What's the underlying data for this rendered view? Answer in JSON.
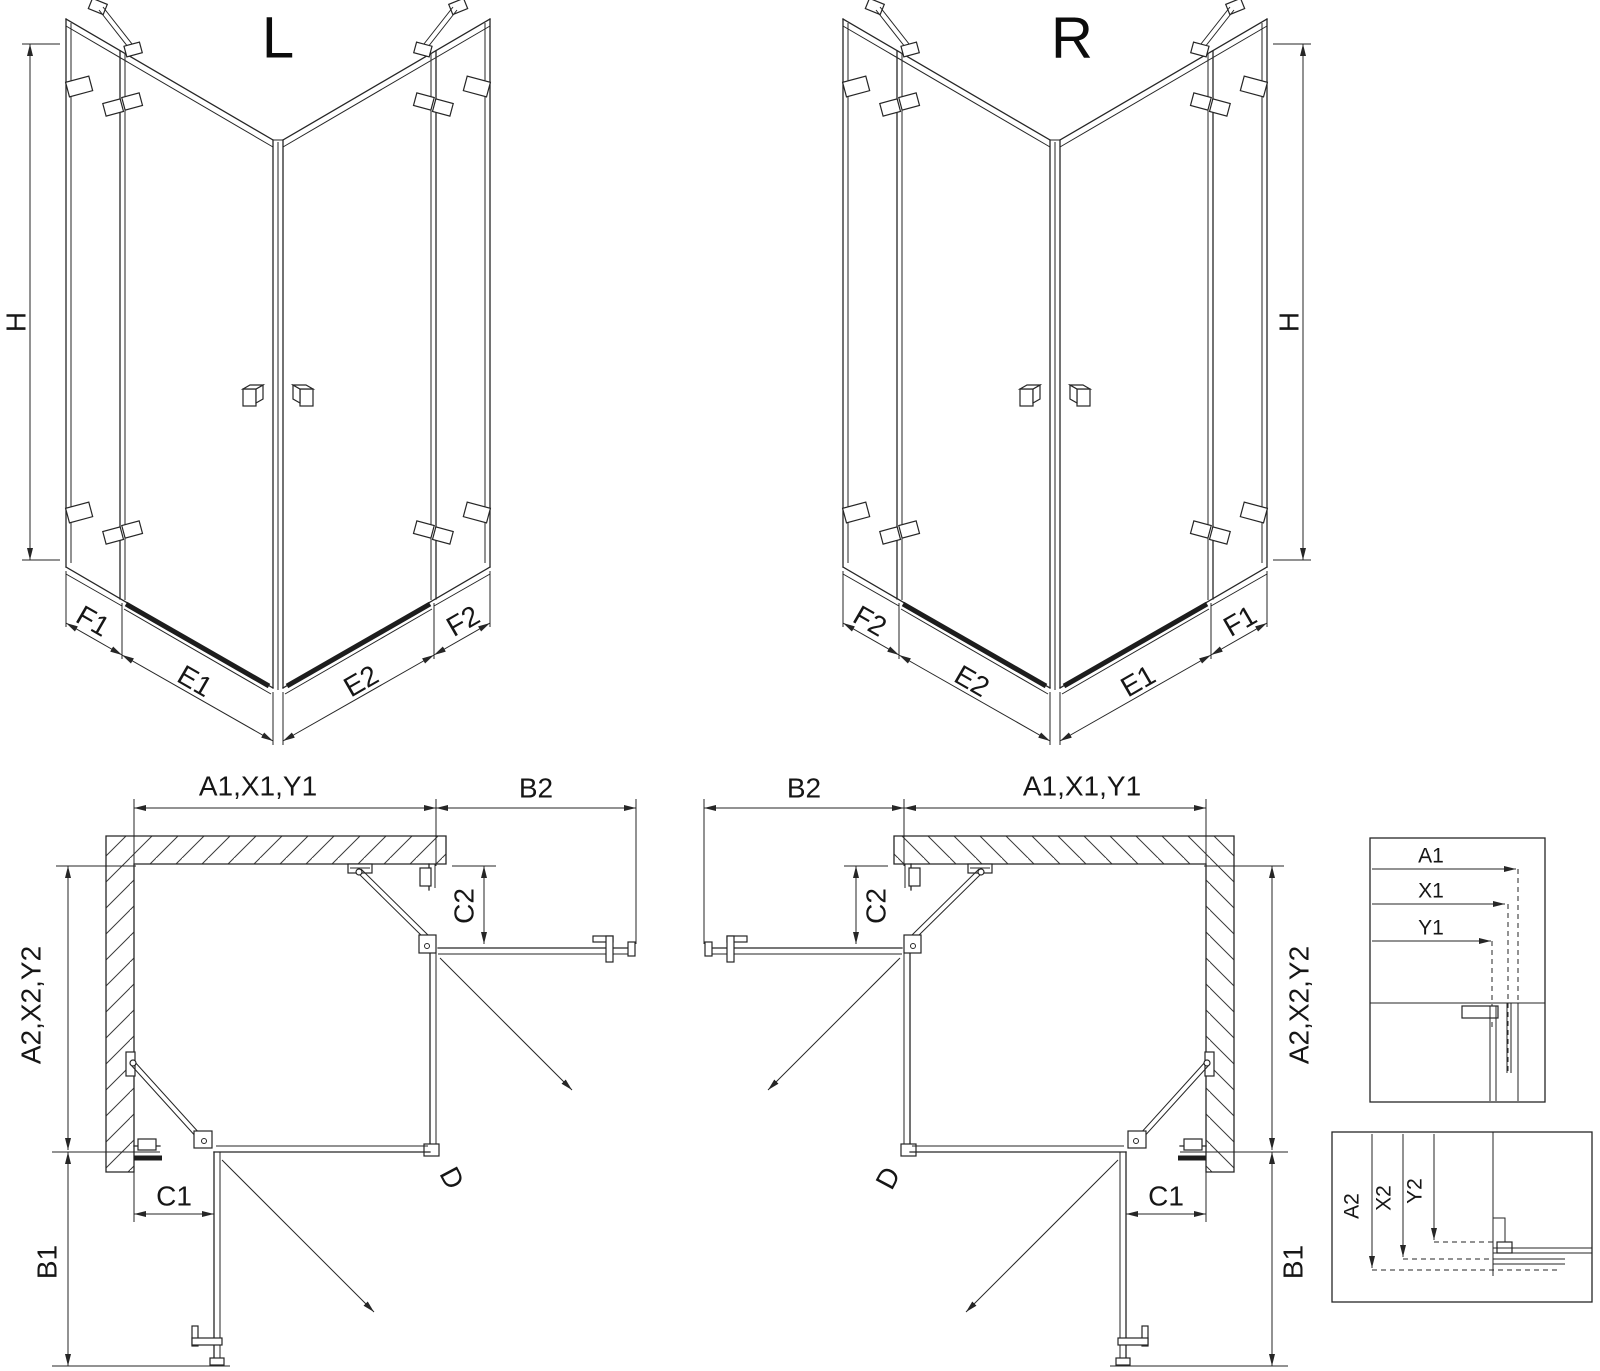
{
  "drawing": {
    "background": "#ffffff",
    "ink": "#262626",
    "iso_left": {
      "variant": "L",
      "height": "H",
      "segments": [
        "F1",
        "E1",
        "E2",
        "F2"
      ]
    },
    "iso_right": {
      "variant": "R",
      "height": "H",
      "segments": [
        "F2",
        "E2",
        "E1",
        "F1"
      ]
    },
    "plan_left": {
      "width_top": "A1,X1,Y1",
      "width_return_top": "B2",
      "depth_side": "A2,X2,Y2",
      "return_bottom": "B1",
      "fixed_panel_side": "C2",
      "fixed_panel_bottom": "C1",
      "diagonal_entry": "D"
    },
    "plan_right": {
      "width_top": "A1,X1,Y1",
      "width_return_top": "B2",
      "depth_side": "A2,X2,Y2",
      "return_bottom": "B1",
      "fixed_panel_side": "C2",
      "fixed_panel_bottom": "C1",
      "diagonal_entry": "D"
    },
    "detail_width": {
      "labels": [
        "A1",
        "X1",
        "Y1"
      ]
    },
    "detail_depth": {
      "labels": [
        "A2",
        "X2",
        "Y2"
      ]
    }
  }
}
